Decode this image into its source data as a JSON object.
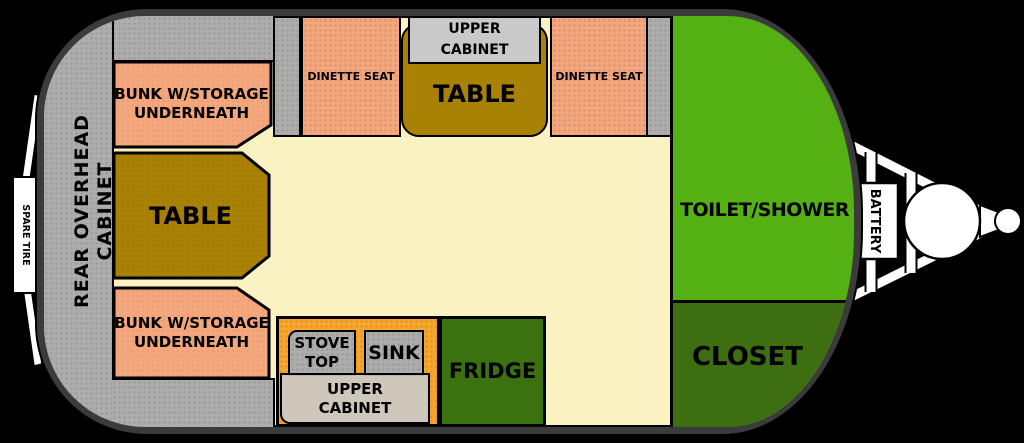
{
  "labels": {
    "spare_tire": "SPARE TIRE",
    "rear_overhead_cabinet": "REAR OVERHEAD CABINET",
    "bunk_top_line1": "BUNK W/STORAGE",
    "bunk_top_line2": "UNDERNEATH",
    "table_left": "TABLE",
    "dinette_left": "DINETTE SEAT",
    "upper_cabinet_top_line1": "UPPER",
    "upper_cabinet_top_line2": "CABINET",
    "table_center": "TABLE",
    "dinette_right": "DINETTE SEAT",
    "toilet_shower": "TOILET/SHOWER",
    "closet": "CLOSET",
    "battery": "BATTERY",
    "bunk_bottom_line1": "BUNK W/STORAGE",
    "bunk_bottom_line2": "UNDERNEATH",
    "stove_line1": "STOVE",
    "stove_line2": "TOP",
    "sink": "SINK",
    "upper_cabinet_bottom_line1": "UPPER",
    "upper_cabinet_bottom_line2": "CABINET",
    "fridge": "FRIDGE"
  },
  "colors": {
    "background": "#000000",
    "body_border": "#3b3b3b",
    "floor": "#fbf2c4",
    "cabinet_gray": "#adadad",
    "upper_cabinet_gray": "#c9c9c9",
    "seat_peach": "#f4a67c",
    "table_gold": "#a98104",
    "counter_orange": "#f7a62b",
    "toilet_green": "#54b013",
    "closet_green": "#3d6e11",
    "fixture_white": "#ffffff"
  }
}
